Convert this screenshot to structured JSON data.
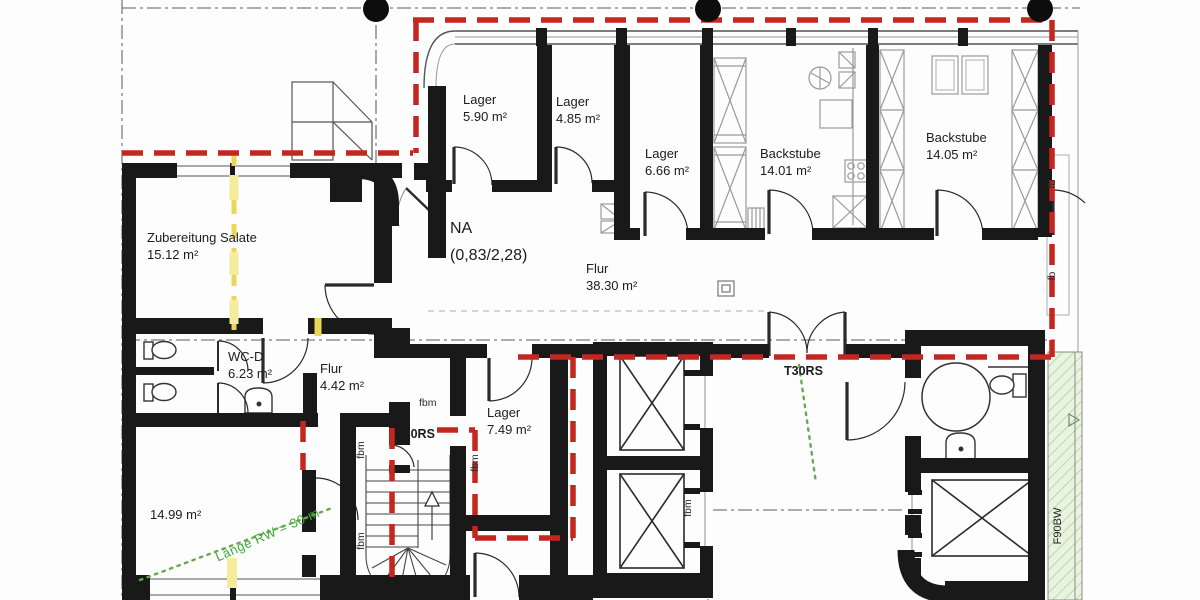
{
  "plan_title": "Grundriss Bäckerei / Erdgeschoss",
  "rooms": {
    "lager_590": {
      "name": "Lager",
      "area": "5.90 m²"
    },
    "lager_485": {
      "name": "Lager",
      "area": "4.85 m²"
    },
    "lager_666": {
      "name": "Lager",
      "area": "6.66 m²"
    },
    "backstube_1401": {
      "name": "Backstube",
      "area": "14.01 m²"
    },
    "backstube_1405": {
      "name": "Backstube",
      "area": "14.05 m²"
    },
    "zubereitung": {
      "name": "Zubereitung Salate",
      "area": "15.12 m²"
    },
    "flur_main": {
      "name": "Flur",
      "area": "38.30 m²"
    },
    "wc_d": {
      "name": "WC-D",
      "area": "6.23 m²"
    },
    "flur_small": {
      "name": "Flur",
      "area": "4.42 m²"
    },
    "lager_749": {
      "name": "Lager",
      "area": "7.49 m²"
    },
    "room_sw": {
      "area": "14.99 m²"
    }
  },
  "annotations": {
    "na": "NA",
    "na_dim": "(0,83/2,28)",
    "t30rs": "T30RS",
    "fbm": "fbm",
    "fb": "fb",
    "f90bw": "F90BW",
    "escape_note": "Länge RW = 30 m"
  },
  "colors": {
    "escape_route_red": "#c3271e",
    "firewall_yellow": "#ead75a",
    "escape_green": "#3daa35",
    "hatch_green_fill": "#e9f4e0",
    "wall_black": "#191919"
  }
}
